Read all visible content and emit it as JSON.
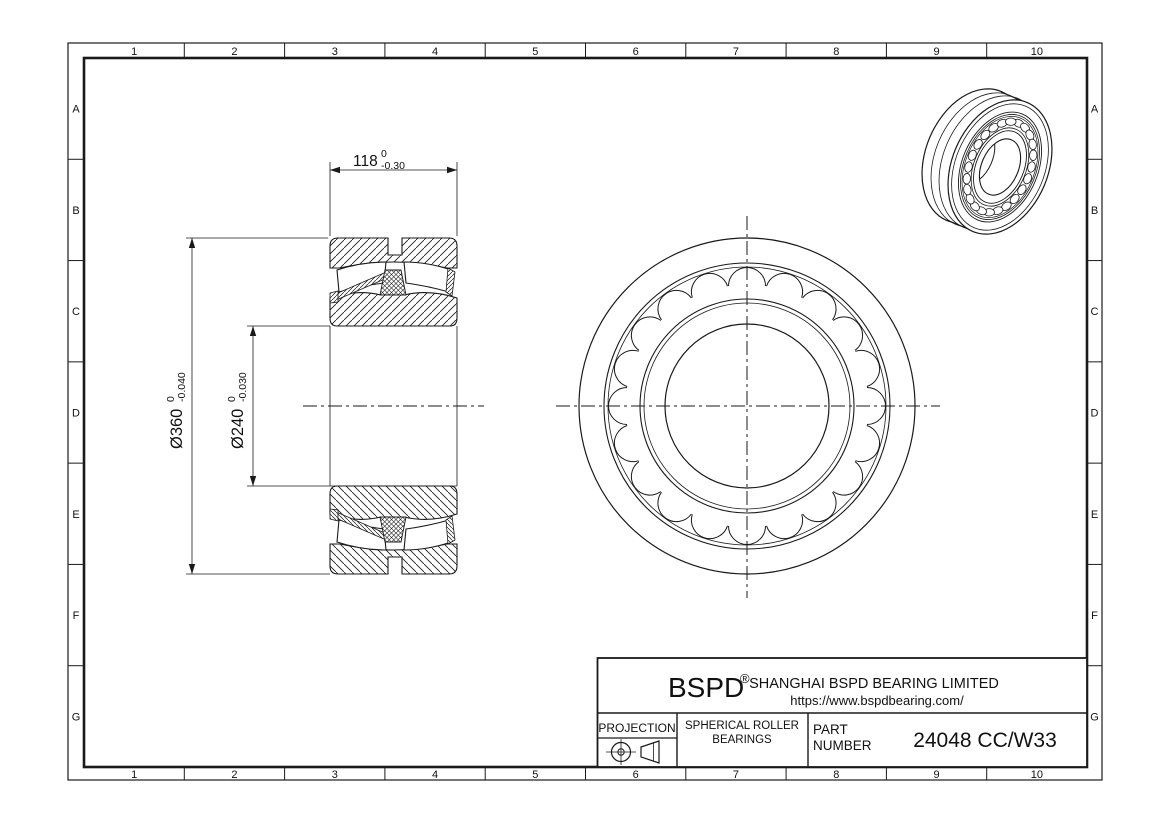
{
  "sheet": {
    "grid": {
      "columns": [
        "1",
        "2",
        "3",
        "4",
        "5",
        "6",
        "7",
        "8",
        "9",
        "10"
      ],
      "rows": [
        "A",
        "B",
        "C",
        "D",
        "E",
        "F",
        "G"
      ]
    }
  },
  "dimensions": {
    "width": {
      "nominal": "118",
      "tol_upper": "0",
      "tol_lower": "-0.30"
    },
    "outer_diameter": {
      "nominal": "Ø360",
      "tol_upper": "0",
      "tol_lower": "-0.040"
    },
    "bore_diameter": {
      "nominal": "Ø240",
      "tol_upper": "0",
      "tol_lower": "-0.030"
    }
  },
  "front_view": {
    "visible_rollers": 20
  },
  "iso_view": {
    "visible_rollers": 24
  },
  "title_block": {
    "brand": "BSPD",
    "registered_mark": "®",
    "company": "SHANGHAI BSPD BEARING LIMITED",
    "website": "https://www.bspdbearing.com/",
    "projection_label": "PROJECTION",
    "product_type_line1": "SPHERICAL ROLLER",
    "product_type_line2": "BEARINGS",
    "part_label_line1": "PART",
    "part_label_line2": "NUMBER",
    "part_number": "24048 CC/W33"
  },
  "colors": {
    "line": "#1a1a1a",
    "background": "#ffffff"
  }
}
